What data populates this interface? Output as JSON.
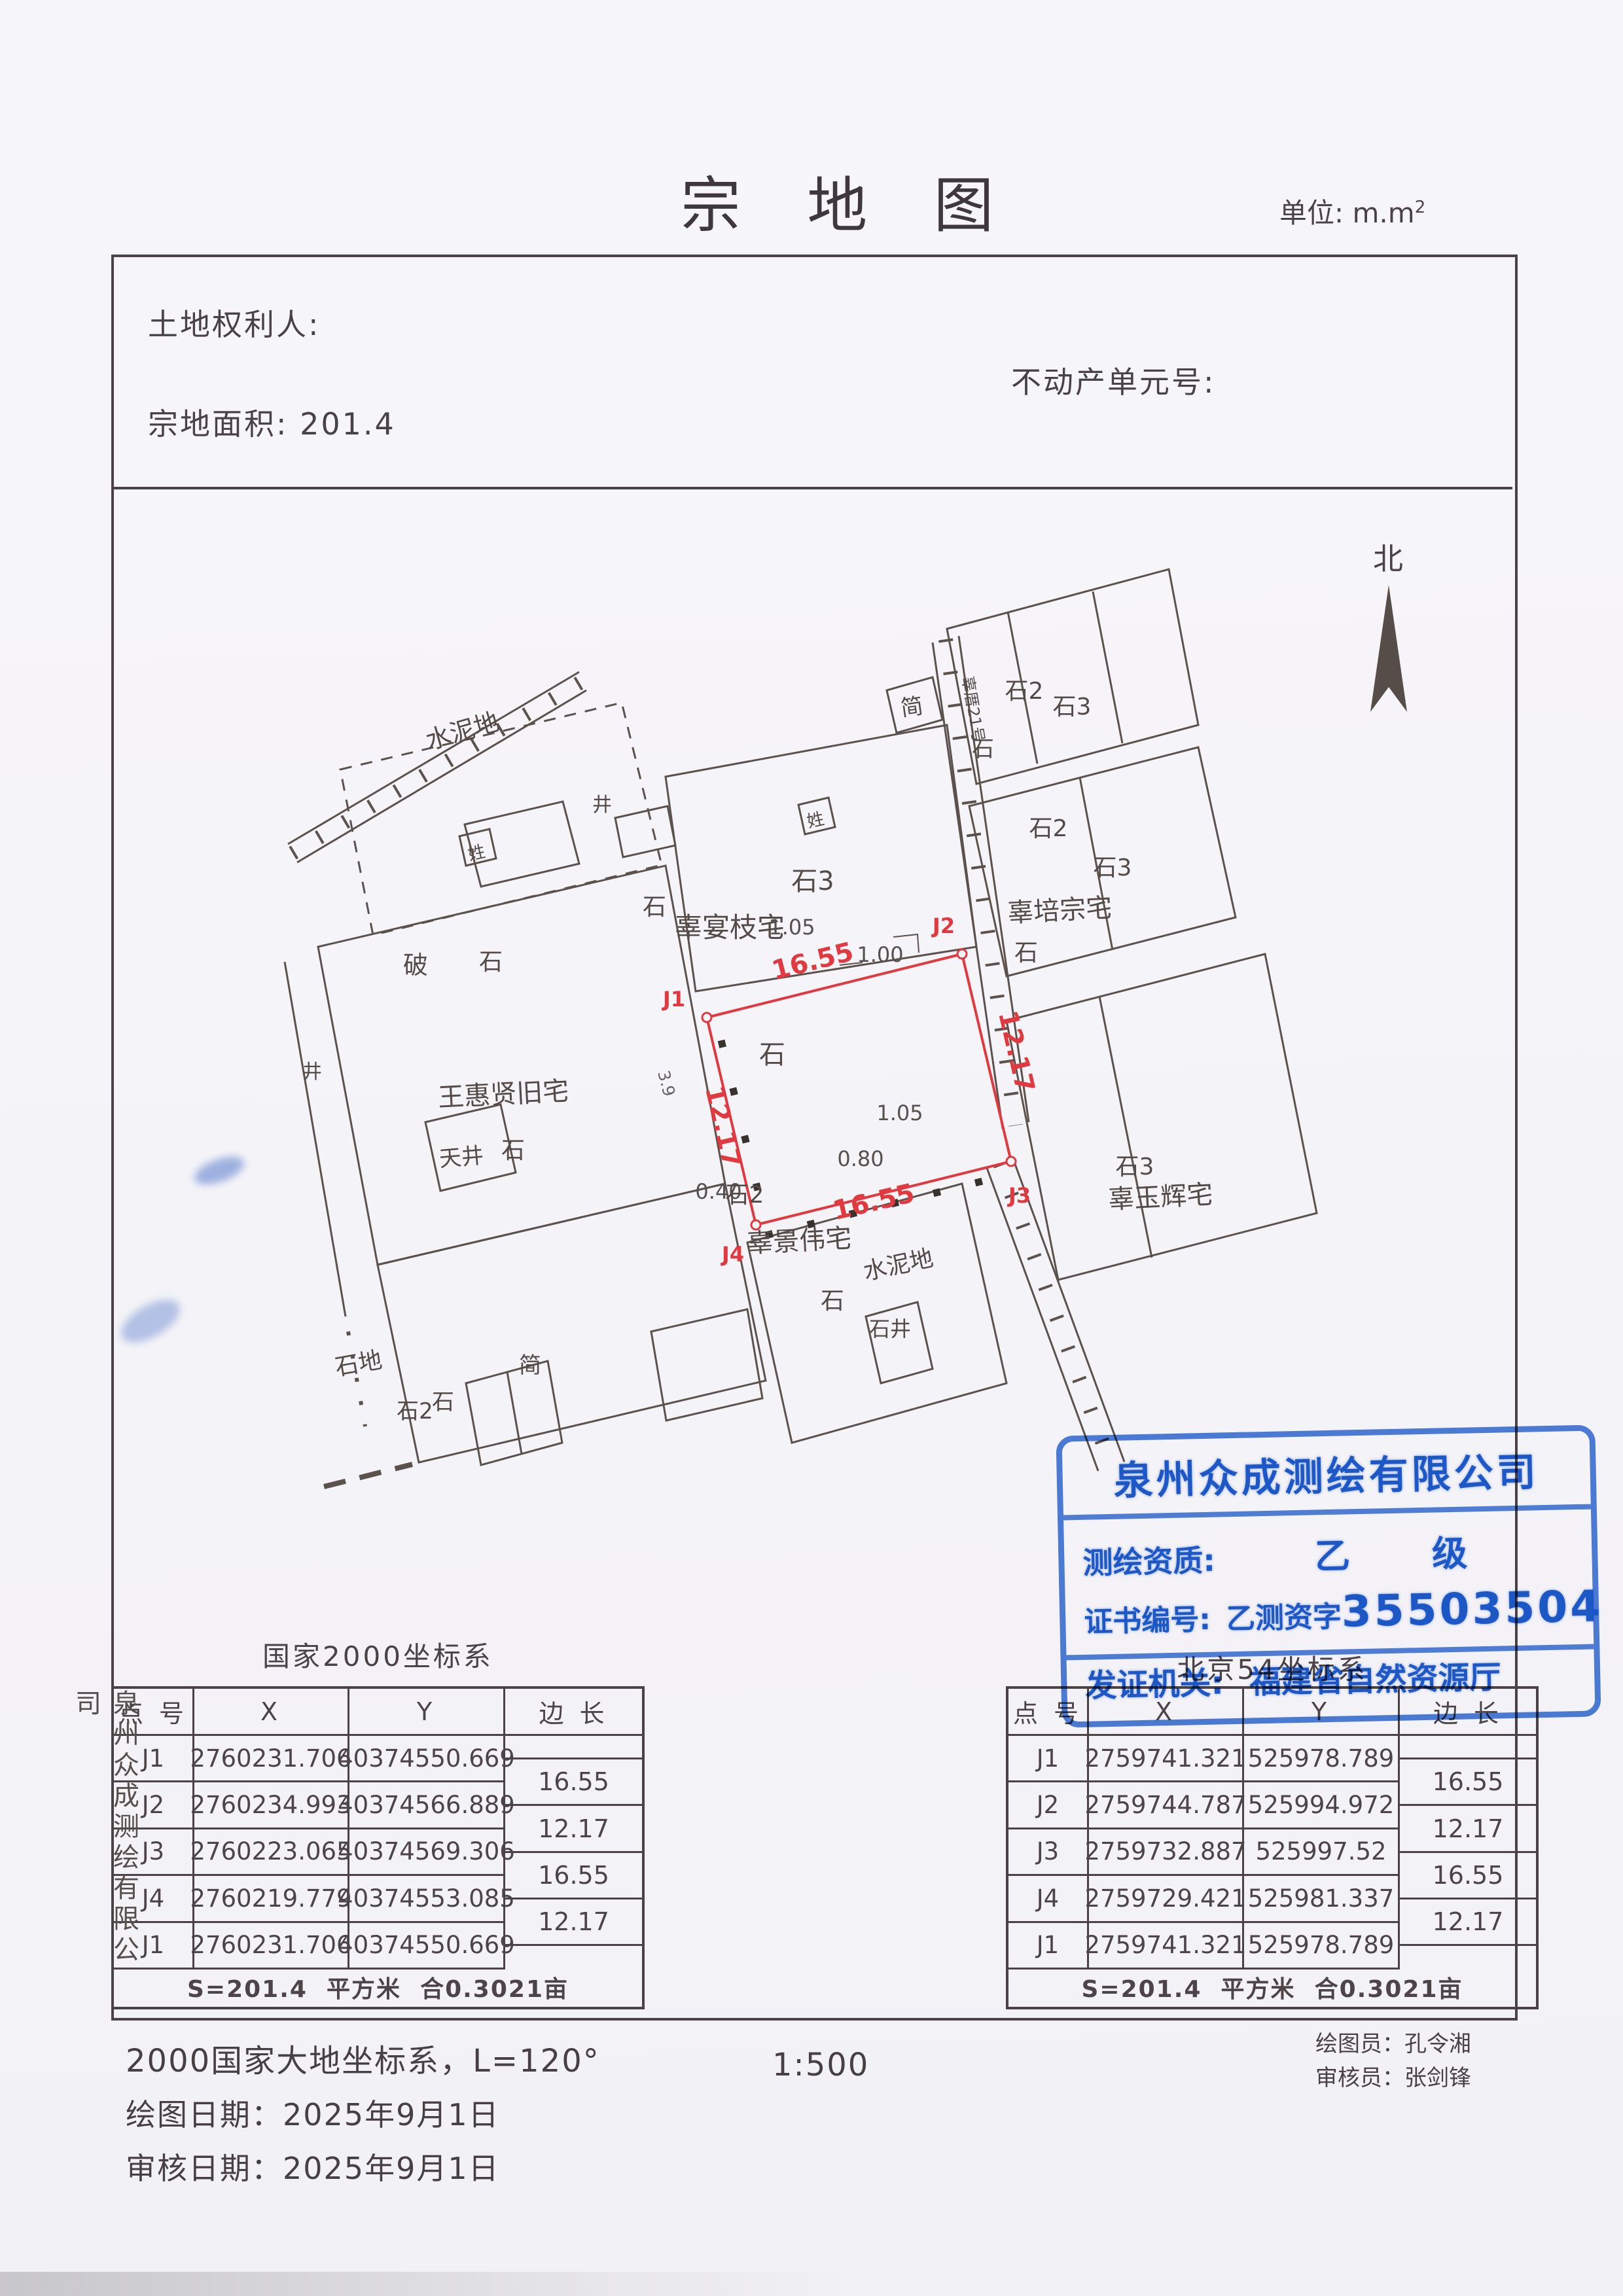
{
  "header": {
    "title": "宗 地 图",
    "unit_label": "单位: m.m",
    "unit_sup": "2",
    "land_rights_holder": "土地权利人:",
    "real_estate_unit_no": "不动产单元号:",
    "parcel_area": "宗地面积: 201.4"
  },
  "compass": {
    "north": "北"
  },
  "map": {
    "labels": [
      "水泥地",
      "简",
      "石3",
      "辜宴枝宅",
      "石",
      "石",
      "辜厝21号",
      "石2",
      "石3",
      "石",
      "石2",
      "石3",
      "辜培宗宅",
      "石",
      "破",
      "石",
      "王惠贤旧宅",
      "天井",
      "石",
      "石地",
      "石2",
      "石",
      "简",
      "石2",
      "辜景伟宅",
      "石",
      "水泥地",
      "石井",
      "辜玉辉宅",
      "石3",
      "井",
      "井",
      "姓",
      "姓"
    ],
    "red_edges": [
      "16.55",
      "12.17",
      "16.55",
      "12.17"
    ],
    "red_points": [
      "J1",
      "J2",
      "J3",
      "J4"
    ],
    "dims": [
      "1.05",
      "1.00",
      "1.05",
      "0.80",
      "0.40",
      "3.9"
    ],
    "red_color": "#e03a40",
    "line_color": "#5b514d"
  },
  "stamp": {
    "company": "泉州众成测绘有限公司",
    "quali_label": "测绘资质:",
    "quali_value": "乙    级",
    "cert_label": "证书编号:",
    "cert_prefix": "乙测资字",
    "cert_number": "35503504",
    "issuer_label": "发证机关:",
    "issuer_value": "福建省自然资源厅",
    "color": "#2160d1"
  },
  "tables": {
    "left": {
      "title": "国家2000坐标系",
      "headers": [
        "点 号",
        "X",
        "Y",
        "边 长"
      ],
      "rows": [
        [
          "J1",
          "2760231.706",
          "40374550.669"
        ],
        [
          "J2",
          "2760234.993",
          "40374566.889"
        ],
        [
          "J3",
          "2760223.065",
          "40374569.306"
        ],
        [
          "J4",
          "2760219.779",
          "40374553.085"
        ],
        [
          "J1",
          "2760231.706",
          "40374550.669"
        ]
      ],
      "edges": [
        "16.55",
        "12.17",
        "16.55",
        "12.17"
      ],
      "summary": "S=201.4  平方米  合0.3021亩"
    },
    "right": {
      "title": "北京54坐标系",
      "headers": [
        "点 号",
        "X",
        "Y",
        "边 长"
      ],
      "rows": [
        [
          "J1",
          "2759741.321",
          "525978.789"
        ],
        [
          "J2",
          "2759744.787",
          "525994.972"
        ],
        [
          "J3",
          "2759732.887",
          "525997.52"
        ],
        [
          "J4",
          "2759729.421",
          "525981.337"
        ],
        [
          "J1",
          "2759741.321",
          "525978.789"
        ]
      ],
      "edges": [
        "16.55",
        "12.17",
        "16.55",
        "12.17"
      ],
      "summary": "S=201.4  平方米  合0.3021亩"
    }
  },
  "footer": {
    "coord_note": "2000国家大地坐标系，L=120°",
    "scale": "1:500",
    "draw_date": "绘图日期：2025年9月1日",
    "review_date": "审核日期：2025年9月1日",
    "drafter": "绘图员：孔令湘",
    "reviewer": "审核员：张剑锋"
  },
  "sidebar": {
    "company_vertical": "泉州众成测绘有限公司"
  }
}
